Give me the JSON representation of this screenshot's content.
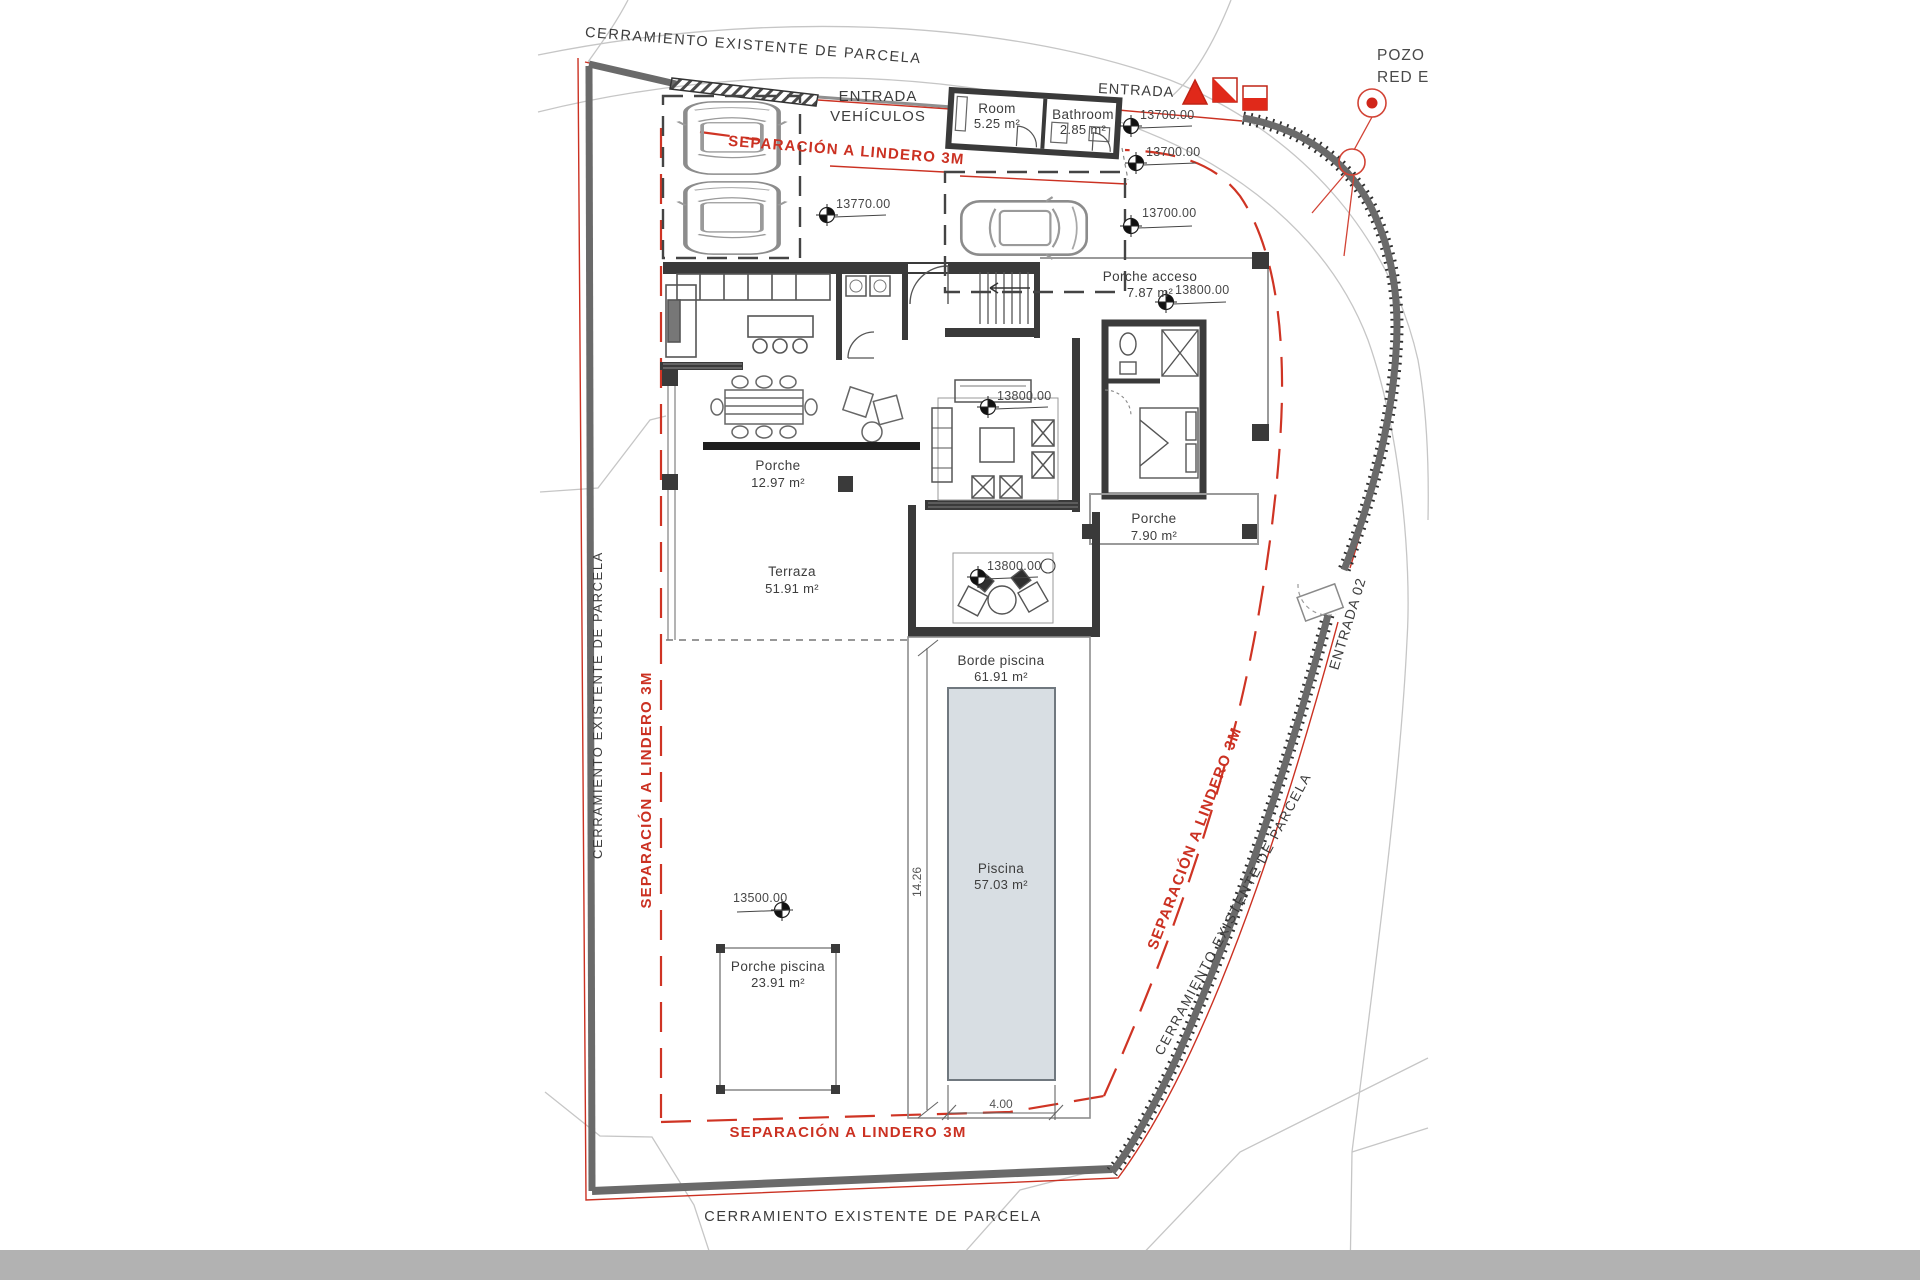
{
  "drawing": {
    "fence_label": "CERRAMIENTO EXISTENTE DE PARCELA",
    "setback_label": "SEPARACIÓN A LINDERO 3M",
    "vehicle_entrance_line1": "ENTRADA",
    "vehicle_entrance_line2": "VEHÍCULOS",
    "entrance": "ENTRADA",
    "entrance_02": "ENTRADA 02",
    "well_label_1": "POZO I",
    "well_label_2": "RED EX"
  },
  "rooms": {
    "room": {
      "name": "Room",
      "area": "5.25 m²"
    },
    "bathroom": {
      "name": "Bathroom",
      "area": "2.85 m²"
    },
    "porche_acceso": {
      "name": "Porche acceso",
      "area": "7.87 m²"
    },
    "porche_west": {
      "name": "Porche",
      "area": "12.97 m²"
    },
    "terraza": {
      "name": "Terraza",
      "area": "51.91 m²"
    },
    "porche_east": {
      "name": "Porche",
      "area": "7.90 m²"
    },
    "borde_piscina": {
      "name": "Borde piscina",
      "area": "61.91 m²"
    },
    "piscina": {
      "name": "Piscina",
      "area": "57.03 m²"
    },
    "porche_piscina": {
      "name": "Porche piscina",
      "area": "23.91 m²"
    }
  },
  "levels": {
    "parking": "13770.00",
    "entrance_top": "13700.00",
    "entrance_mid": "13700.00",
    "entrance_low": "13700.00",
    "porche_acceso": "13800.00",
    "living": "13800.00",
    "terraza": "13800.00",
    "pool_area": "13500.00"
  },
  "dimensions": {
    "pool_length": "14.26",
    "pool_width": "4.00"
  },
  "colors": {
    "accent_red": "#cb3122",
    "fence_gray": "#6a6a6a",
    "pool_fill": "#d8dee3",
    "ground_strip": "#b2b2b2"
  }
}
